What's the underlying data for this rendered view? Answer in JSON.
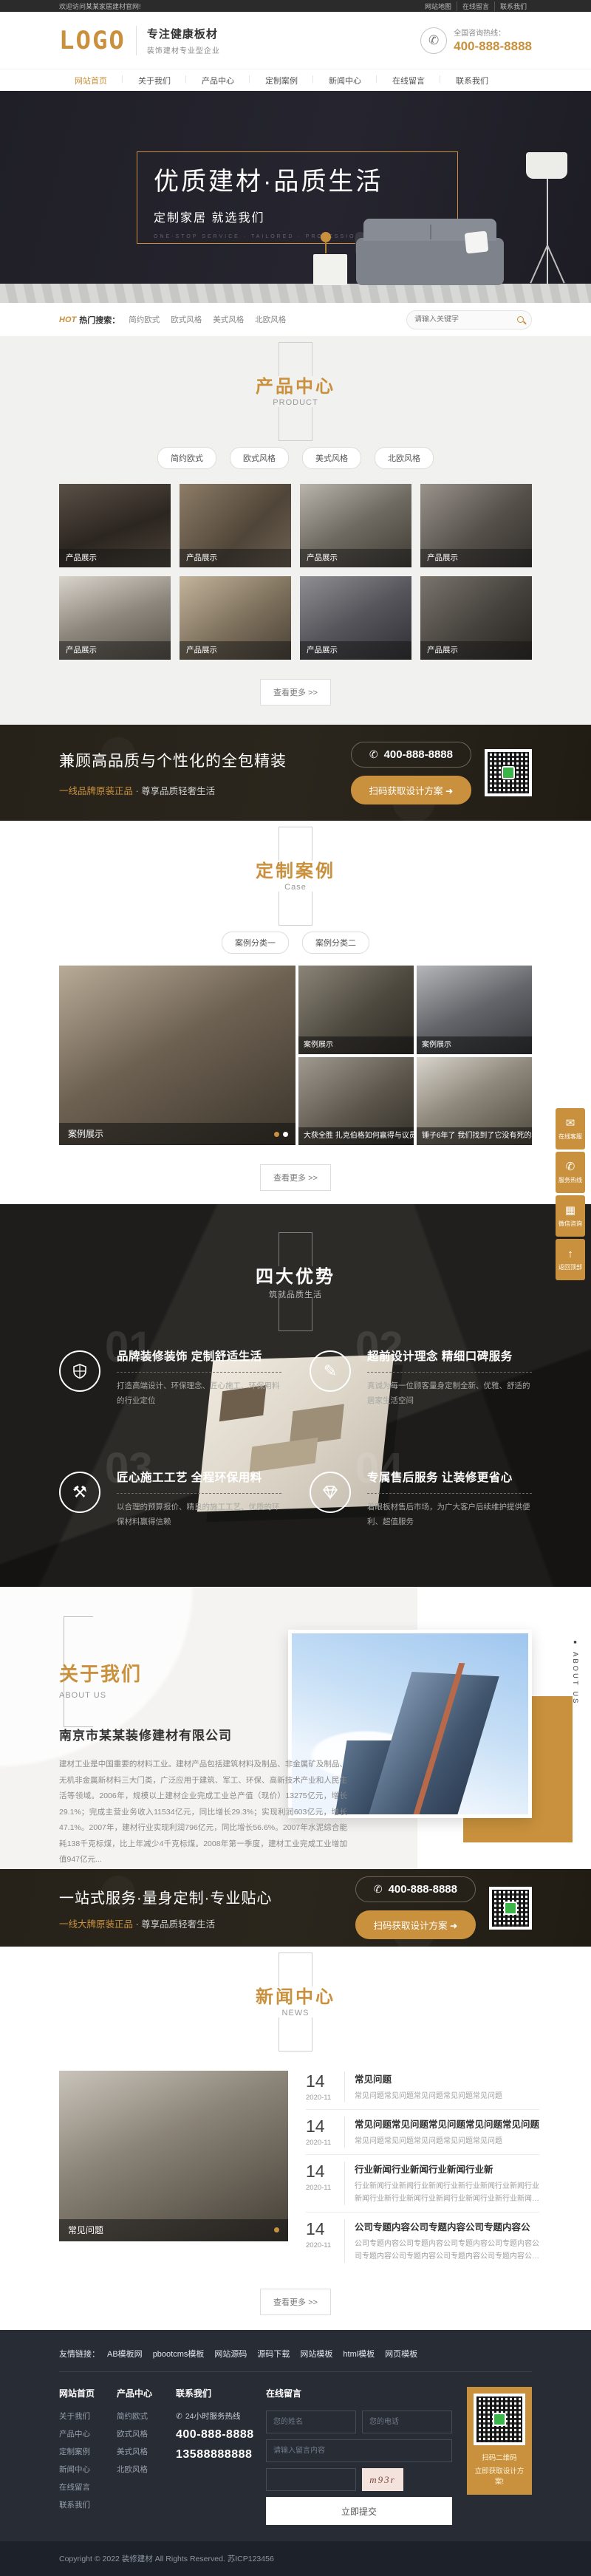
{
  "topbar": {
    "welcome": "欢迎访问某某家居建材官网!",
    "links": [
      {
        "label": "网站地图"
      },
      {
        "label": "在线留言"
      },
      {
        "label": "联系我们"
      }
    ]
  },
  "header": {
    "logo": "LOGO",
    "slogan_main": "专注健康板材",
    "slogan_sub": "装饰建材专业型企业",
    "hotline_label": "全国咨询热线：",
    "hotline_number": "400-888-8888",
    "accent_color": "#c9913d"
  },
  "nav": {
    "items": [
      {
        "label": "网站首页",
        "active": true
      },
      {
        "label": "关于我们"
      },
      {
        "label": "产品中心"
      },
      {
        "label": "定制案例"
      },
      {
        "label": "新闻中心"
      },
      {
        "label": "在线留言"
      },
      {
        "label": "联系我们"
      }
    ]
  },
  "hero": {
    "title": "优质建材·品质生活",
    "subtitle": "定制家居 就选我们",
    "tagline": "ONE-STOP SERVICE · TAILORED · PROFESSIONAL · INTIMATE"
  },
  "search": {
    "hot": "HOT",
    "hot_label": "热门搜索：",
    "keywords": [
      "简约欧式",
      "欧式风格",
      "美式风格",
      "北欧风格"
    ],
    "placeholder": "请输入关键字"
  },
  "products": {
    "title": "产品中心",
    "subtitle": "PRODUCT",
    "filters": [
      "简约欧式",
      "欧式风格",
      "美式风格",
      "北欧风格"
    ],
    "items": [
      "产品展示",
      "产品展示",
      "产品展示",
      "产品展示",
      "产品展示",
      "产品展示",
      "产品展示",
      "产品展示"
    ],
    "more": "查看更多 >>"
  },
  "cta1": {
    "title": "兼顾高品质与个性化的全包精装",
    "subtitle_gold": "一线品牌原装正品",
    "subtitle_rest": " · 尊享品质轻奢生活",
    "phone": "400-888-8888",
    "button": "扫码获取设计方案 ➜"
  },
  "cases": {
    "title": "定制案例",
    "subtitle": "Case",
    "filters": [
      "案例分类一",
      "案例分类二"
    ],
    "featured_caption": "案例展示",
    "cells": [
      "案例展示",
      "案例展示",
      "大获全胜 扎克伯格如何赢得与议员的当",
      "锤子6年了 我们找到了它没有死的秘密"
    ],
    "more": "查看更多 >>"
  },
  "advantages": {
    "title": "四大优势",
    "subtitle": "筑就品质生活",
    "items": [
      {
        "num": "01",
        "icon": "shield",
        "title": "品牌装修装饰 定制舒适生活",
        "desc": "打造高端设计、环保理念、匠心施工、环保用料的行业定位"
      },
      {
        "num": "02",
        "icon": "design-pencil",
        "title": "超前设计理念 精细口碑服务",
        "desc": "真诚为每一位顾客量身定制全新、优雅、舒适的居家生活空间"
      },
      {
        "num": "03",
        "icon": "tools",
        "title": "匠心施工工艺 全程环保用料",
        "desc": "以合理的预算报价、精良的施工工艺、优质的环保材料赢得信赖"
      },
      {
        "num": "04",
        "icon": "diamond",
        "title": "专属售后服务 让装修更省心",
        "desc": "着眼板材售后市场，为广大客户后续维护提供便利、超值服务"
      }
    ]
  },
  "about": {
    "title": "关于我们",
    "subtitle": "ABOUT US",
    "company": "南京市某某装修建材有限公司",
    "paragraph": "建材工业是中国重要的材料工业。建材产品包括建筑材料及制品、非金属矿及制品、无机非金属新材料三大门类，广泛应用于建筑、军工、环保、高新技术产业和人民生活等领域。2006年，规模以上建材企业完成工业总产值（现价）13275亿元，增长29.1%；完成主营业务收入11534亿元，同比增长29.3%；实现利润603亿元，增长47.1%。2007年，建材行业实现利润796亿元，同比增长56.6%。2007年水泥综合能耗138千克标煤，比上年减少4千克标煤。2008年第一季度，建材工业完成工业增加值947亿元...",
    "more": "了解详情 >>",
    "side_label": "ABOUT US"
  },
  "cta2": {
    "title": "一站式服务·量身定制·专业贴心",
    "subtitle_gold": "一线大牌原装正品",
    "subtitle_rest": " · 尊享品质轻奢生活",
    "phone": "400-888-8888",
    "button": "扫码获取设计方案 ➜"
  },
  "news": {
    "title": "新闻中心",
    "subtitle": "NEWS",
    "featured_caption": "常见问题",
    "items": [
      {
        "day": "14",
        "date": "2020-11",
        "title": "常见问题",
        "desc": "常见问题常见问题常见问题常见问题常见问题"
      },
      {
        "day": "14",
        "date": "2020-11",
        "title": "常见问题常见问题常见问题常见问题常见问题",
        "desc": "常见问题常见问题常见问题常见问题常见问题"
      },
      {
        "day": "14",
        "date": "2020-11",
        "title": "行业新闻行业新闻行业新闻行业新",
        "desc": "行业新闻行业新闻行业新闻行业新行业新闻行业新闻行业新闻行业新行业新闻行业新闻行业新闻行业新行业新闻行…"
      },
      {
        "day": "14",
        "date": "2020-11",
        "title": "公司专题内容公司专题内容公司专题内容公",
        "desc": "公司专题内容公司专题内容公司专题内容公司专题内容公司专题内容公司专题内容公司专题内容公司专题内容公司…"
      }
    ],
    "more": "查看更多 >>"
  },
  "side_widgets": [
    {
      "label": "在线客服",
      "icon": "chat"
    },
    {
      "label": "服务热线",
      "icon": "phone"
    },
    {
      "label": "微信咨询",
      "icon": "qr"
    },
    {
      "label": "返回顶部",
      "icon": "arrow-up"
    }
  ],
  "footer": {
    "links_label": "友情链接：",
    "links": [
      "AB模板网",
      "pbootcms模板",
      "网站源码",
      "源码下载",
      "网站模板",
      "html模板",
      "网页模板"
    ],
    "col1": {
      "title": "网站首页",
      "items": [
        "关于我们",
        "产品中心",
        "定制案例",
        "新闻中心",
        "在线留言",
        "联系我们"
      ]
    },
    "col2": {
      "title": "产品中心",
      "items": [
        "简约欧式",
        "欧式风格",
        "美式风格",
        "北欧风格"
      ]
    },
    "col3": {
      "title": "联系我们",
      "service_label": "24小时服务热线",
      "phone1": "400-888-8888",
      "phone2": "13588888888"
    },
    "form": {
      "title": "在线留言",
      "name_placeholder": "您的姓名",
      "phone_placeholder": "您的电话",
      "message_placeholder": "请输入留言内容",
      "captcha_text": "m93r",
      "submit": "立即提交"
    },
    "qr_caption1": "扫码二维码",
    "qr_caption2": "立即获取设计方案!",
    "copyright": "Copyright © 2022 装修建材 All Rights Reserved.  苏ICP123456"
  }
}
